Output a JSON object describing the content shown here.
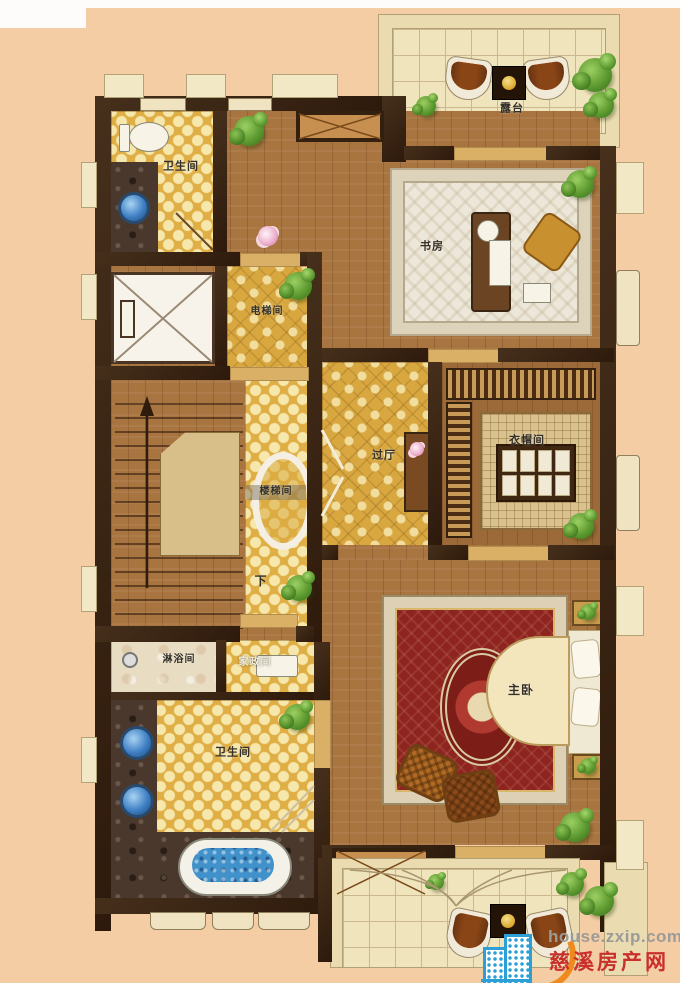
{
  "floor_plan": {
    "type": "residential-floor-plan",
    "rooms": {
      "terrace_top": "露台",
      "bathroom_top": "卫生间",
      "study": "书房",
      "elevator_hall": "电梯间",
      "stairwell": "楼梯间",
      "stair_down": "下",
      "hallway": "过厅",
      "cloakroom": "衣帽间",
      "shower_room": "淋浴间",
      "housekeeping": "家政间",
      "bathroom_master": "卫生间",
      "master_bedroom": "主卧"
    }
  },
  "watermark": {
    "site": "house.zxip.com",
    "name": "慈溪房产网",
    "icon": "building-icon",
    "site_color": "#9b9b99",
    "name_color": "#c9302c",
    "logo_color": "#2b9fd6",
    "swoosh_color": "#ef8a1f"
  },
  "palette": {
    "background": "#f5cda4",
    "wall": "#38220f",
    "wood_floor": "#a87440",
    "gold_tile": "#dfae44",
    "terrace_tile": "#f0e4bd",
    "carpet_red": "#8e2420",
    "water_blue": "#4191ca"
  }
}
